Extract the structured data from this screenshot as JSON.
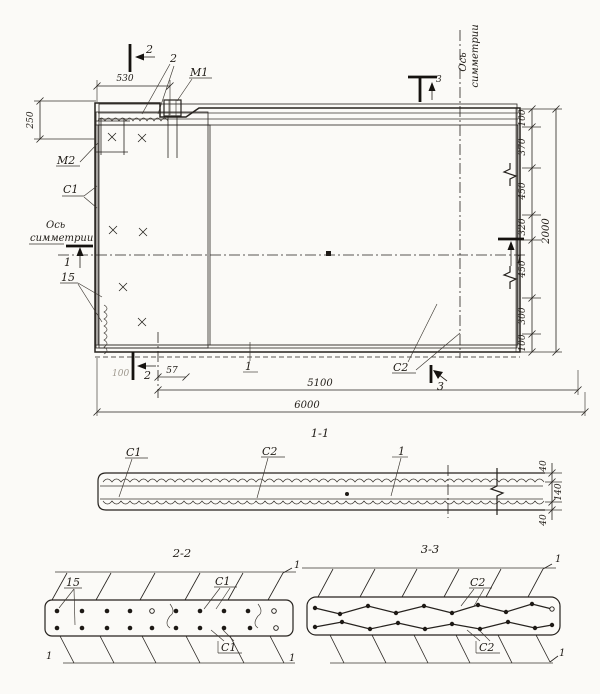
{
  "plan": {
    "cut_labels": {
      "s1": "1",
      "s2": "2",
      "s3": "3"
    },
    "part_labels": {
      "m1": "M1",
      "m2": "M2",
      "c1": "C1",
      "c2": "C2",
      "n15": "15",
      "bar1": "1",
      "bar2": "2"
    },
    "axis": {
      "line1": "Ось",
      "line2": "симметрии"
    },
    "dims": {
      "d530": "530",
      "d250": "250",
      "d57": "57",
      "d100_faint": "100",
      "d5100": "5100",
      "d6000": "6000",
      "d2000": "2000",
      "chain": [
        "100",
        "370",
        "450",
        "320",
        "450",
        "300",
        "100"
      ]
    }
  },
  "section_1_1": {
    "title": "1-1",
    "c1": "C1",
    "c2": "C2",
    "bar1": "1",
    "d40": "40",
    "d140": "140"
  },
  "section_2_2": {
    "title": "2-2",
    "n15": "15",
    "c1": "C1",
    "corner": "1"
  },
  "section_3_3": {
    "title": "3-3",
    "c2": "C2",
    "corner": "1"
  }
}
